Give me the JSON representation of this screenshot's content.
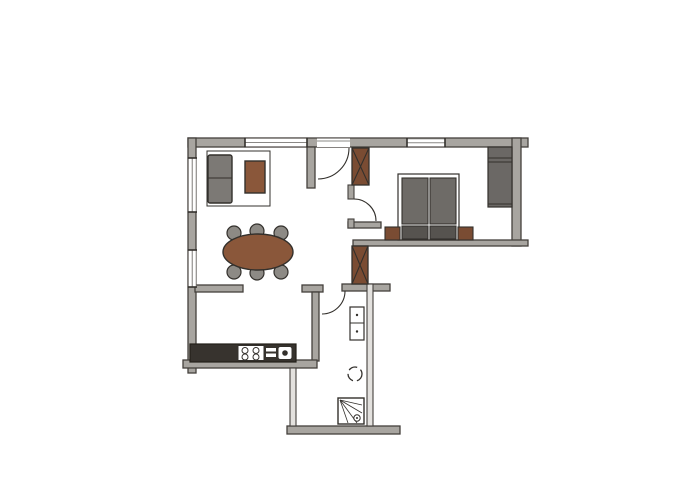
{
  "meta": {
    "kind": "hand-sketched apartment floor plan, no text labels"
  },
  "canvas": {
    "width": 700,
    "height": 500
  },
  "palette": {
    "floor": "#ffffff",
    "wall": "#a8a5a0",
    "wallEdge": "#44403c",
    "thinFill": "#e3e1de",
    "white": "#ffffff",
    "line": "#33302c",
    "winLine": "#8a8885",
    "brown": "#8a573a",
    "brownDark": "#7a4c33",
    "sofa": "#7c7975",
    "mattress": "#6e6b67",
    "bedDark": "#56534f",
    "wardrobe": "#6b6865",
    "chair": "#8d8a85",
    "counter": "#37332e",
    "counterEdge": "#232019"
  },
  "shapes": [
    {
      "name": "wall-top",
      "kind": "rect",
      "x": 188,
      "y": 138,
      "w": 340,
      "h": 9,
      "fill": "wall",
      "stroke": "wallEdge",
      "sw": 1.3
    },
    {
      "name": "wall-left",
      "kind": "rect",
      "x": 188,
      "y": 138,
      "w": 8,
      "h": 235,
      "fill": "wall",
      "stroke": "wallEdge",
      "sw": 1.3
    },
    {
      "name": "wall-right",
      "kind": "rect",
      "x": 512,
      "y": 138,
      "w": 9,
      "h": 108,
      "fill": "wall",
      "stroke": "wallEdge",
      "sw": 1.3
    },
    {
      "name": "wall-bedroom-south",
      "kind": "rect",
      "x": 353,
      "y": 240,
      "w": 175,
      "h": 6,
      "fill": "wall",
      "stroke": "wallEdge",
      "sw": 1.3
    },
    {
      "name": "wall-entry-south",
      "kind": "rect",
      "x": 348,
      "y": 222,
      "w": 33,
      "h": 6,
      "fill": "wall",
      "stroke": "wallEdge",
      "sw": 1.3
    },
    {
      "name": "wall-entry-west",
      "kind": "rect",
      "x": 307,
      "y": 147,
      "w": 8,
      "h": 41,
      "fill": "wall",
      "stroke": "wallEdge",
      "sw": 1.3
    },
    {
      "name": "wall-bedroom-door-jamb-north",
      "kind": "rect",
      "x": 348,
      "y": 185,
      "w": 6,
      "h": 14,
      "fill": "wall",
      "stroke": "wallEdge",
      "sw": 1.1
    },
    {
      "name": "wall-bedroom-door-jamb-south",
      "kind": "rect",
      "x": 348,
      "y": 219,
      "w": 6,
      "h": 9,
      "fill": "wall",
      "stroke": "wallEdge",
      "sw": 1.1
    },
    {
      "name": "wall-living-south-west",
      "kind": "rect",
      "x": 195,
      "y": 285,
      "w": 48,
      "h": 7,
      "fill": "wall",
      "stroke": "wallEdge",
      "sw": 1.3
    },
    {
      "name": "wall-living-south-mid",
      "kind": "rect",
      "x": 302,
      "y": 285,
      "w": 21,
      "h": 7,
      "fill": "wall",
      "stroke": "wallEdge",
      "sw": 1.3
    },
    {
      "name": "wall-bath-north",
      "kind": "rect",
      "x": 342,
      "y": 284,
      "w": 48,
      "h": 7,
      "fill": "wall",
      "stroke": "wallEdge",
      "sw": 1.3
    },
    {
      "name": "wall-kitchen-east",
      "kind": "rect",
      "x": 312,
      "y": 292,
      "w": 7,
      "h": 69,
      "fill": "wall",
      "stroke": "wallEdge",
      "sw": 1.3
    },
    {
      "name": "wall-kitchen-south",
      "kind": "rect",
      "x": 183,
      "y": 360,
      "w": 134,
      "h": 8,
      "fill": "wall",
      "stroke": "wallEdge",
      "sw": 1.3
    },
    {
      "name": "wall-exterior-bottom",
      "kind": "rect",
      "x": 287,
      "y": 426,
      "w": 113,
      "h": 8,
      "fill": "wall",
      "stroke": "wallEdge",
      "sw": 1.3
    },
    {
      "name": "wall-corridor-west-thin",
      "kind": "rect",
      "x": 290,
      "y": 368,
      "w": 6,
      "h": 58,
      "fill": "thinFill",
      "stroke": "wallEdge",
      "sw": 1.1
    },
    {
      "name": "wall-bath-east-thin",
      "kind": "rect",
      "x": 367,
      "y": 284,
      "w": 6,
      "h": 142,
      "fill": "thinFill",
      "stroke": "wallEdge",
      "sw": 1.1
    },
    {
      "name": "window-top-living",
      "kind": "window",
      "x": 245,
      "y": 138.5,
      "w": 62,
      "h": 8,
      "orient": "h"
    },
    {
      "name": "window-top-bedroom",
      "kind": "window",
      "x": 407,
      "y": 139,
      "w": 38,
      "h": 7.5,
      "orient": "h"
    },
    {
      "name": "window-left-upper",
      "kind": "window",
      "x": 188.5,
      "y": 158,
      "w": 7.5,
      "h": 54,
      "orient": "v"
    },
    {
      "name": "window-left-lower",
      "kind": "window",
      "x": 188.5,
      "y": 250,
      "w": 7.5,
      "h": 37,
      "orient": "v"
    },
    {
      "name": "entry-door-opening",
      "kind": "rect",
      "x": 317,
      "y": 138.5,
      "w": 33,
      "h": 8.5,
      "fill": "white"
    },
    {
      "name": "entry-door-threshold",
      "kind": "line",
      "x1": 317,
      "y1": 141,
      "x2": 350,
      "y2": 141,
      "stroke": "winLine",
      "sw": 1
    },
    {
      "name": "duct-shaft-upper",
      "kind": "xbox",
      "x": 352,
      "y": 148,
      "w": 17,
      "h": 37
    },
    {
      "name": "duct-shaft-lower",
      "kind": "xbox",
      "x": 352,
      "y": 246,
      "w": 16,
      "h": 38
    },
    {
      "name": "living-rug",
      "kind": "rect",
      "x": 207,
      "y": 151,
      "w": 63,
      "h": 55,
      "fill": "white",
      "stroke": "line",
      "sw": 1
    },
    {
      "name": "sofa",
      "kind": "rect",
      "x": 208,
      "y": 155,
      "w": 24,
      "h": 48,
      "fill": "sofa",
      "stroke": "line",
      "sw": 1.4,
      "rx": 2
    },
    {
      "name": "sofa-cushion-divider",
      "kind": "line",
      "x1": 208.5,
      "y1": 178,
      "x2": 231.5,
      "y2": 178,
      "stroke": "line",
      "sw": 1.1
    },
    {
      "name": "coffee-table",
      "kind": "rect",
      "x": 245,
      "y": 161,
      "w": 20,
      "h": 32,
      "fill": "brown",
      "stroke": "line",
      "sw": 1.4
    },
    {
      "name": "dining-chair",
      "kind": "circle",
      "cx": 234,
      "cy": 233,
      "r": 7,
      "fill": "chair",
      "stroke": "line",
      "sw": 1.2
    },
    {
      "name": "dining-chair",
      "kind": "circle",
      "cx": 257,
      "cy": 231,
      "r": 7,
      "fill": "chair",
      "stroke": "line",
      "sw": 1.2
    },
    {
      "name": "dining-chair",
      "kind": "circle",
      "cx": 281,
      "cy": 233,
      "r": 7,
      "fill": "chair",
      "stroke": "line",
      "sw": 1.2
    },
    {
      "name": "dining-chair",
      "kind": "circle",
      "cx": 234,
      "cy": 272,
      "r": 7,
      "fill": "chair",
      "stroke": "line",
      "sw": 1.2
    },
    {
      "name": "dining-chair",
      "kind": "circle",
      "cx": 257,
      "cy": 273,
      "r": 7,
      "fill": "chair",
      "stroke": "line",
      "sw": 1.2
    },
    {
      "name": "dining-chair",
      "kind": "circle",
      "cx": 281,
      "cy": 272,
      "r": 7,
      "fill": "chair",
      "stroke": "line",
      "sw": 1.2
    },
    {
      "name": "dining-table",
      "kind": "ellipse",
      "cx": 258,
      "cy": 252,
      "rx": 35,
      "ry": 18,
      "fill": "brown",
      "stroke": "line",
      "sw": 1.4
    },
    {
      "name": "bed-frame",
      "kind": "rect",
      "x": 398,
      "y": 174,
      "w": 61,
      "h": 66,
      "fill": "white",
      "stroke": "line",
      "sw": 1.2
    },
    {
      "name": "bed-mattress-left",
      "kind": "rect",
      "x": 402,
      "y": 178,
      "w": 26,
      "h": 46,
      "fill": "mattress",
      "stroke": "line",
      "sw": 1.1
    },
    {
      "name": "bed-mattress-right",
      "kind": "rect",
      "x": 430,
      "y": 178,
      "w": 26,
      "h": 46,
      "fill": "mattress",
      "stroke": "line",
      "sw": 1.1
    },
    {
      "name": "bed-pillow-left",
      "kind": "rect",
      "x": 402,
      "y": 226,
      "w": 26,
      "h": 13,
      "fill": "bedDark",
      "stroke": "line",
      "sw": 1.1
    },
    {
      "name": "bed-pillow-right",
      "kind": "rect",
      "x": 430,
      "y": 226,
      "w": 26,
      "h": 13,
      "fill": "bedDark",
      "stroke": "line",
      "sw": 1.1
    },
    {
      "name": "nightstand-left",
      "kind": "rect",
      "x": 385,
      "y": 227,
      "w": 15,
      "h": 13,
      "fill": "brownDark",
      "stroke": "line",
      "sw": 1.1
    },
    {
      "name": "nightstand-right",
      "kind": "rect",
      "x": 458,
      "y": 227,
      "w": 15,
      "h": 13,
      "fill": "brownDark",
      "stroke": "line",
      "sw": 1.1
    },
    {
      "name": "wardrobe",
      "kind": "rect",
      "x": 488,
      "y": 147,
      "w": 24,
      "h": 60,
      "fill": "wardrobe",
      "stroke": "line",
      "sw": 1.2
    },
    {
      "name": "wardrobe-shelf-line",
      "kind": "line",
      "x1": 488,
      "y1": 158,
      "x2": 512,
      "y2": 158,
      "stroke": "line",
      "sw": 1
    },
    {
      "name": "wardrobe-shelf-line",
      "kind": "line",
      "x1": 488,
      "y1": 162,
      "x2": 512,
      "y2": 162,
      "stroke": "line",
      "sw": 1
    },
    {
      "name": "wardrobe-shelf-line",
      "kind": "line",
      "x1": 488,
      "y1": 204,
      "x2": 512,
      "y2": 204,
      "stroke": "line",
      "sw": 1
    },
    {
      "name": "kitchen-counter",
      "kind": "rect",
      "x": 190,
      "y": 344,
      "w": 106,
      "h": 18,
      "fill": "counter",
      "stroke": "counterEdge",
      "sw": 1.2
    },
    {
      "name": "stove",
      "kind": "rect",
      "x": 238,
      "y": 345.5,
      "w": 26,
      "h": 15,
      "fill": "white",
      "stroke": "line",
      "sw": 1
    },
    {
      "name": "stove-burner",
      "kind": "circle",
      "cx": 245,
      "cy": 350.5,
      "r": 3,
      "fill": "white",
      "stroke": "line",
      "sw": 1
    },
    {
      "name": "stove-burner",
      "kind": "circle",
      "cx": 256,
      "cy": 350.5,
      "r": 3,
      "fill": "white",
      "stroke": "line",
      "sw": 1
    },
    {
      "name": "stove-burner",
      "kind": "circle",
      "cx": 245,
      "cy": 357,
      "r": 3,
      "fill": "white",
      "stroke": "line",
      "sw": 1
    },
    {
      "name": "stove-burner",
      "kind": "circle",
      "cx": 256,
      "cy": 357,
      "r": 3,
      "fill": "white",
      "stroke": "line",
      "sw": 1
    },
    {
      "name": "sink-drainer",
      "kind": "rect",
      "x": 266,
      "y": 348,
      "w": 10,
      "h": 3.5,
      "fill": "white"
    },
    {
      "name": "sink-drainer",
      "kind": "rect",
      "x": 266,
      "y": 353.5,
      "w": 10,
      "h": 3.5,
      "fill": "white"
    },
    {
      "name": "sink-basin",
      "kind": "rect",
      "x": 278,
      "y": 346.5,
      "w": 14,
      "h": 13,
      "fill": "white",
      "stroke": "line",
      "sw": 1,
      "rx": 2.5
    },
    {
      "name": "sink-faucet",
      "kind": "circle",
      "cx": 285,
      "cy": 353,
      "r": 2.8,
      "fill": "line"
    },
    {
      "name": "washer-dryer-stack",
      "kind": "rect",
      "x": 350,
      "y": 307,
      "w": 14,
      "h": 33,
      "fill": "white",
      "stroke": "line",
      "sw": 1.2
    },
    {
      "name": "washer-dryer-divider",
      "kind": "line",
      "x1": 350,
      "y1": 323,
      "x2": 364,
      "y2": 323,
      "stroke": "line",
      "sw": 1
    },
    {
      "name": "washer-knob",
      "kind": "circle",
      "cx": 357,
      "cy": 315,
      "r": 1.2,
      "fill": "line"
    },
    {
      "name": "washer-knob",
      "kind": "circle",
      "cx": 357,
      "cy": 331.5,
      "r": 1.2,
      "fill": "line"
    },
    {
      "name": "toilet",
      "kind": "circle",
      "cx": 355,
      "cy": 374,
      "r": 7,
      "fill": "white",
      "stroke": "line",
      "sw": 1.3,
      "dash": "9 4"
    },
    {
      "name": "shower-tray",
      "kind": "rect",
      "x": 338,
      "y": 398,
      "w": 26,
      "h": 26,
      "fill": "white",
      "stroke": "line",
      "sw": 1.4
    },
    {
      "name": "shower-spray-line",
      "kind": "line",
      "x1": 340,
      "y1": 400,
      "x2": 362,
      "y2": 405,
      "stroke": "line",
      "sw": 0.8
    },
    {
      "name": "shower-spray-line",
      "kind": "line",
      "x1": 340,
      "y1": 400,
      "x2": 362,
      "y2": 413,
      "stroke": "line",
      "sw": 0.8
    },
    {
      "name": "shower-spray-line",
      "kind": "line",
      "x1": 340,
      "y1": 400,
      "x2": 357,
      "y2": 423,
      "stroke": "line",
      "sw": 0.8
    },
    {
      "name": "shower-spray-line",
      "kind": "line",
      "x1": 340,
      "y1": 400,
      "x2": 348,
      "y2": 423,
      "stroke": "line",
      "sw": 0.8
    },
    {
      "name": "shower-drain",
      "kind": "circle",
      "cx": 357,
      "cy": 418,
      "r": 3.2,
      "fill": "white",
      "stroke": "line",
      "sw": 1
    },
    {
      "name": "shower-drain-dot",
      "kind": "circle",
      "cx": 357,
      "cy": 418,
      "r": 1,
      "fill": "line"
    },
    {
      "name": "entry-door-swing",
      "kind": "path",
      "d": "M 349 148 A 31 31 0 0 1 318 179",
      "stroke": "line",
      "sw": 1.1
    },
    {
      "name": "bedroom-door-swing",
      "kind": "path",
      "d": "M 354 199 A 22 22 0 0 1 376 221",
      "stroke": "line",
      "sw": 1.1
    },
    {
      "name": "bathroom-door-swing",
      "kind": "path",
      "d": "M 345 291 A 23 23 0 0 1 322 314",
      "stroke": "line",
      "sw": 1.1
    }
  ]
}
